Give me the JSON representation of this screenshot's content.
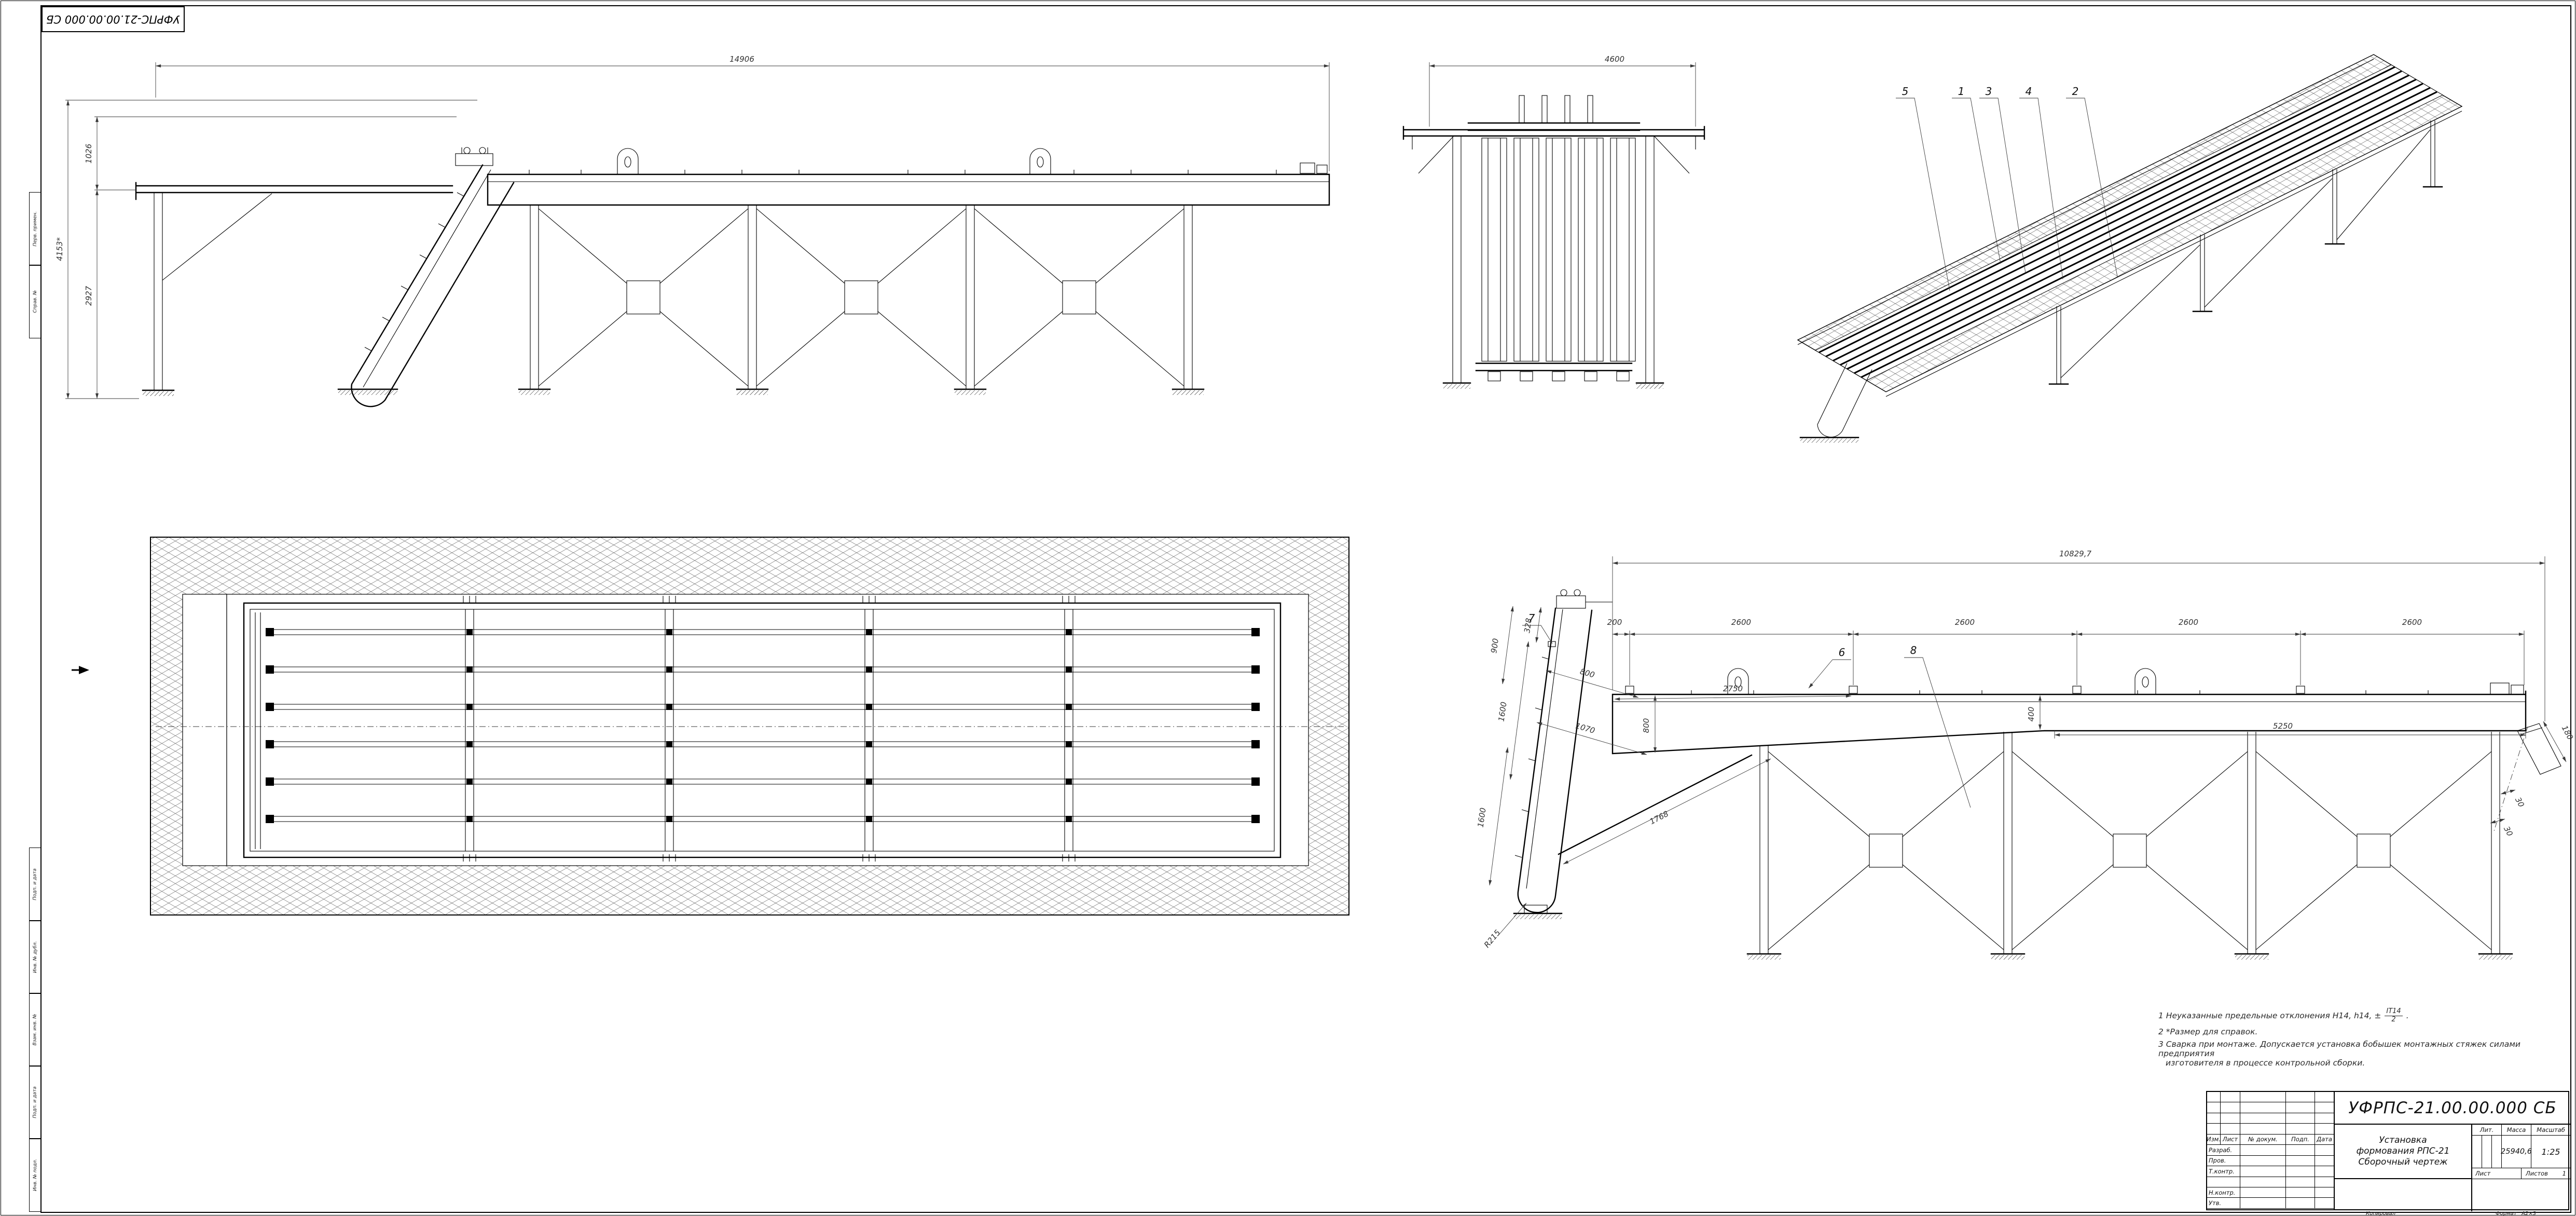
{
  "sheet": {
    "corner_stamp": "УФРПС-21.00.00.000 СБ"
  },
  "notes": {
    "line1_text": "1  Неуказанные предельные отклонения H14, h14,  ±",
    "line1_frac_num": "IT14",
    "line1_frac_den": "2",
    "line1_end": ".",
    "line2": "2  *Размер для справок.",
    "line3": "3  Сварка при монтаже. Допускается установка бобышек монтажных стяжек силами предприятия",
    "line4": "изготовителя в процессе контрольной сборки."
  },
  "titleblock": {
    "doc_number": "УФРПС-21.00.00.000 СБ",
    "title_lines": [
      "Установка",
      "формования РПС-21",
      "Сборочный чертеж"
    ],
    "header_cells": [
      "Изм.",
      "Лист",
      "№ докум.",
      "Подп.",
      "Дата"
    ],
    "roles": [
      "Разраб.",
      "Пров.",
      "Т.контр.",
      "",
      "Н.контр.",
      "Утв."
    ],
    "lit_label": "Лит.",
    "mass_label": "Масса",
    "scale_label": "Масштаб",
    "mass_value": "25940,6",
    "scale_value": "1:25",
    "sheet_label": "Лист",
    "sheets_label": "Листов",
    "sheets_value": "1",
    "copied_label": "Копировал",
    "format_label": "Формат",
    "format_value": "А2×3"
  },
  "frame_labels": {
    "perv": "Перв. примен.",
    "sprav": "Справ. №",
    "podp1": "Подп. и дата",
    "inv_dubl": "Инв. № дубл.",
    "vzam": "Взам. инв. №",
    "podp2": "Подп. и дата",
    "inv_podl": "Инв. № подл."
  },
  "views": {
    "side": {
      "dims": {
        "overall": "14906",
        "height": "4153*",
        "upper": "1026",
        "lower": "2927"
      }
    },
    "front": {
      "dims": {
        "width": "4600"
      }
    },
    "iso": {
      "callouts": [
        "5",
        "1",
        "3",
        "4",
        "2"
      ]
    },
    "side2": {
      "dims": {
        "overall": "10829,7",
        "seg200": "200",
        "seg2600": "2600",
        "d5250": "5250",
        "d400": "400",
        "d800v": "800",
        "d900": "900",
        "d328": "328",
        "d1600a": "1600",
        "d1600b": "1600",
        "d800i": "800",
        "d1070": "1070",
        "d2750": "2750",
        "d1768": "1768",
        "r215": "R215",
        "d180": "180",
        "d30a": "30",
        "d30b": "30"
      },
      "callouts": {
        "c7": "7",
        "c6": "6",
        "c8": "8"
      }
    }
  }
}
